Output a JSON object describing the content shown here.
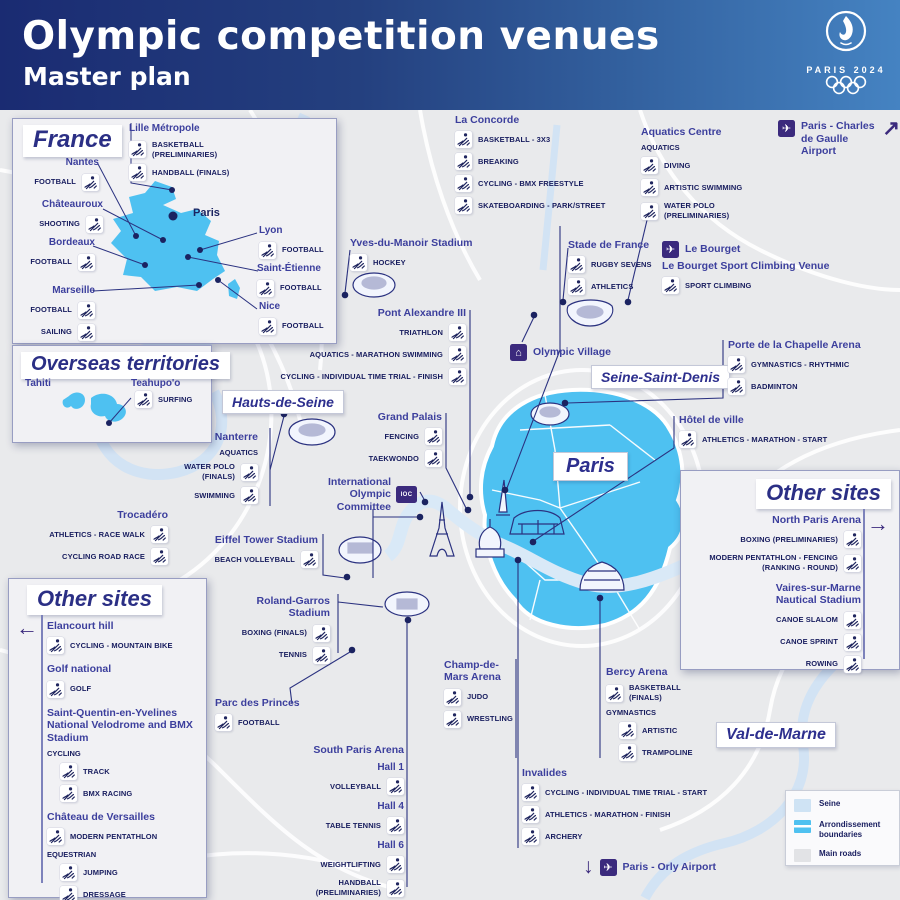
{
  "header": {
    "title": "Olympic competition venues",
    "subtitle": "Master plan",
    "brand": "PARIS 2024"
  },
  "colors": {
    "paris_area": "#4ec1f1",
    "seine": "#cfe3f4",
    "arrondissement": "#4fc1f0",
    "main_roads": "#e2e3e6",
    "navy_text": "#171c5e",
    "venue_name": "#3c3f9d",
    "purple": "#3b2a7d"
  },
  "map": {
    "regions": [
      {
        "id": "hauts-de-seine",
        "label": "Hauts-de-Seine"
      },
      {
        "id": "seine-saint-denis",
        "label": "Seine-Saint-Denis"
      },
      {
        "id": "paris",
        "label": "Paris"
      },
      {
        "id": "val-de-marne",
        "label": "Val-de-Marne"
      }
    ],
    "airports": {
      "cdg": {
        "label": "Paris - Charles de Gaulle Airport",
        "arrow": "↗"
      },
      "orly": {
        "label": "Paris - Orly Airport",
        "arrow": "↓"
      }
    },
    "callouts": [
      {
        "id": "la-concorde",
        "name": "La Concorde",
        "rows": [
          {
            "icon": "basketball-3x3-icon",
            "label": "BASKETBALL - 3X3"
          },
          {
            "icon": "breaking-icon",
            "label": "BREAKING"
          },
          {
            "icon": "bmx-freestyle-icon",
            "label": "CYCLING - BMX FREESTYLE"
          },
          {
            "icon": "skateboarding-icon",
            "label": "SKATEBOARDING - PARK/STREET"
          }
        ]
      },
      {
        "id": "aquatics-centre",
        "name": "Aquatics Centre",
        "rows": [
          {
            "sub": "AQUATICS",
            "style": "caps"
          },
          {
            "icon": "diving-icon",
            "label": "DIVING"
          },
          {
            "icon": "artistic-swimming-icon",
            "label": "ARTISTIC SWIMMING"
          },
          {
            "icon": "water-polo-icon",
            "label": "WATER POLO (PRELIMINARIES)"
          }
        ]
      },
      {
        "id": "yves-du-manoir",
        "name": "Yves-du-Manoir Stadium",
        "rows": [
          {
            "icon": "hockey-icon",
            "label": "HOCKEY"
          }
        ]
      },
      {
        "id": "stade-de-france",
        "name": "Stade de France",
        "rows": [
          {
            "icon": "rugby-sevens-icon",
            "label": "RUGBY SEVENS"
          },
          {
            "icon": "athletics-icon",
            "label": "ATHLETICS"
          }
        ]
      },
      {
        "id": "le-bourget",
        "name": "Le Bourget",
        "plane": true,
        "name2": "Le Bourget Sport Climbing Venue",
        "rows": [
          {
            "icon": "sport-climbing-icon",
            "label": "SPORT CLIMBING"
          }
        ]
      },
      {
        "id": "pont-alexandre-iii",
        "name": "Pont Alexandre III",
        "align": "R",
        "rows": [
          {
            "icon": "triathlon-icon",
            "label": "TRIATHLON"
          },
          {
            "icon": "marathon-swimming-icon",
            "label": "AQUATICS - MARATHON SWIMMING"
          },
          {
            "icon": "cycling-time-trial-icon",
            "label": "CYCLING - INDIVIDUAL TIME TRIAL - FINISH"
          }
        ]
      },
      {
        "id": "olympic-village",
        "name": "Olympic Village",
        "chip": "village",
        "rows": []
      },
      {
        "id": "porte-de-la-chapelle",
        "name": "Porte de la Chapelle Arena",
        "rows": [
          {
            "icon": "rhythmic-gymnastics-icon",
            "label": "GYMNASTICS - RHYTHMIC"
          },
          {
            "icon": "badminton-icon",
            "label": "BADMINTON"
          }
        ]
      },
      {
        "id": "grand-palais",
        "name": "Grand Palais",
        "align": "R",
        "rows": [
          {
            "icon": "fencing-icon",
            "label": "FENCING"
          },
          {
            "icon": "taekwondo-icon",
            "label": "TAEKWONDO"
          }
        ]
      },
      {
        "id": "hotel-de-ville",
        "name": "Hôtel de ville",
        "rows": [
          {
            "icon": "marathon-icon",
            "label": "ATHLETICS - MARATHON - START"
          }
        ]
      },
      {
        "id": "paris-la-defense",
        "name": "Paris la Défense Arena - Nanterre",
        "align": "R",
        "rows": [
          {
            "sub": "AQUATICS",
            "style": "caps"
          },
          {
            "icon": "water-polo-icon",
            "label": "WATER POLO (FINALS)"
          },
          {
            "icon": "swimming-icon",
            "label": "SWIMMING"
          }
        ]
      },
      {
        "id": "ioc",
        "name": "International Olympic Committee",
        "chip": "IOC",
        "align": "R",
        "rows": []
      },
      {
        "id": "trocadero",
        "name": "Trocadéro",
        "align": "R",
        "rows": [
          {
            "icon": "race-walk-icon",
            "label": "ATHLETICS - RACE WALK"
          },
          {
            "icon": "road-cycling-icon",
            "label": "CYCLING ROAD RACE"
          }
        ]
      },
      {
        "id": "eiffel-tower-stadium",
        "name": "Eiffel Tower Stadium",
        "align": "R",
        "rows": [
          {
            "icon": "beach-volleyball-icon",
            "label": "BEACH VOLLEYBALL"
          }
        ]
      },
      {
        "id": "roland-garros",
        "name": "Roland-Garros Stadium",
        "align": "R",
        "rows": [
          {
            "icon": "boxing-icon",
            "label": "BOXING (FINALS)"
          },
          {
            "icon": "tennis-icon",
            "label": "TENNIS"
          }
        ]
      },
      {
        "id": "parc-des-princes",
        "name": "Parc des Princes",
        "rows": [
          {
            "icon": "football-icon",
            "label": "FOOTBALL"
          }
        ]
      },
      {
        "id": "champ-de-mars",
        "name": "Champ-de-Mars Arena",
        "rows": [
          {
            "icon": "judo-icon",
            "label": "JUDO"
          },
          {
            "icon": "wrestling-icon",
            "label": "WRESTLING"
          }
        ]
      },
      {
        "id": "bercy",
        "name": "Bercy Arena",
        "rows": [
          {
            "icon": "basketball-icon",
            "label": "BASKETBALL (FINALS)"
          },
          {
            "sub": "GYMNASTICS",
            "style": "caps"
          },
          {
            "icon": "artistic-gymnastics-icon",
            "label": "ARTISTIC",
            "indent": true
          },
          {
            "icon": "trampoline-icon",
            "label": "TRAMPOLINE",
            "indent": true
          }
        ]
      },
      {
        "id": "south-paris-arena",
        "name": "South Paris Arena",
        "align": "R",
        "rows": [
          {
            "sub": "Hall 1",
            "style": "hall"
          },
          {
            "icon": "volleyball-icon",
            "label": "VOLLEYBALL"
          },
          {
            "sub": "Hall 4",
            "style": "hall"
          },
          {
            "icon": "table-tennis-icon",
            "label": "TABLE TENNIS"
          },
          {
            "sub": "Hall 6",
            "style": "hall"
          },
          {
            "icon": "weightlifting-icon",
            "label": "WEIGHTLIFTING"
          },
          {
            "icon": "handball-icon",
            "label": "HANDBALL (PRELIMINARIES)"
          }
        ]
      },
      {
        "id": "invalides",
        "name": "Invalides",
        "rows": [
          {
            "icon": "cycling-time-trial-icon",
            "label": "CYCLING - INDIVIDUAL TIME TRIAL - START"
          },
          {
            "icon": "marathon-icon",
            "label": "ATHLETICS - MARATHON - FINISH"
          },
          {
            "icon": "archery-icon",
            "label": "ARCHERY"
          }
        ]
      }
    ],
    "legend": {
      "items": [
        {
          "name": "seine",
          "label": "Seine",
          "color": "#cfe3f4"
        },
        {
          "name": "arrondissement-boundaries",
          "label": "Arrondissement boundaries",
          "color": "#4fc1f0"
        },
        {
          "name": "main-roads",
          "label": "Main roads",
          "color": "#e2e3e6"
        }
      ]
    }
  },
  "france_box": {
    "title": "France",
    "paris_label": "Paris",
    "cities": [
      {
        "id": "lille",
        "name": "Lille Métropole",
        "rows": [
          {
            "icon": "basketball-icon",
            "label": "BASKETBALL (PRELIMINARIES)"
          },
          {
            "icon": "handball-icon",
            "label": "HANDBALL (FINALS)"
          }
        ]
      },
      {
        "id": "nantes",
        "name": "Nantes",
        "align": "R",
        "rows": [
          {
            "icon": "football-icon",
            "label": "FOOTBALL"
          }
        ]
      },
      {
        "id": "chateauroux",
        "name": "Châteauroux",
        "align": "R",
        "rows": [
          {
            "icon": "shooting-icon",
            "label": "SHOOTING"
          }
        ]
      },
      {
        "id": "bordeaux",
        "name": "Bordeaux",
        "align": "R",
        "rows": [
          {
            "icon": "football-icon",
            "label": "FOOTBALL"
          }
        ]
      },
      {
        "id": "marseille",
        "name": "Marseille",
        "align": "R",
        "rows": [
          {
            "icon": "football-icon",
            "label": "FOOTBALL"
          },
          {
            "icon": "sailing-icon",
            "label": "SAILING"
          }
        ]
      },
      {
        "id": "lyon",
        "name": "Lyon",
        "rows": [
          {
            "icon": "football-icon",
            "label": "FOOTBALL"
          }
        ]
      },
      {
        "id": "saint-etienne",
        "name": "Saint-Étienne",
        "rows": [
          {
            "icon": "football-icon",
            "label": "FOOTBALL"
          }
        ]
      },
      {
        "id": "nice",
        "name": "Nice",
        "rows": [
          {
            "icon": "football-icon",
            "label": "FOOTBALL"
          }
        ]
      }
    ]
  },
  "overseas_box": {
    "title": "Overseas territories",
    "tahiti_label": "Tahiti",
    "teahupoo_label": "Teahupo'o",
    "rows": [
      {
        "icon": "surfing-icon",
        "label": "SURFING"
      }
    ]
  },
  "other_sites_left": {
    "title": "Other sites",
    "venues": [
      {
        "name": "Elancourt hill",
        "rows": [
          {
            "icon": "mountain-bike-icon",
            "label": "CYCLING - MOUNTAIN BIKE"
          }
        ]
      },
      {
        "name": "Golf national",
        "rows": [
          {
            "icon": "golf-icon",
            "label": "GOLF"
          }
        ]
      },
      {
        "name": "Saint-Quentin-en-Yvelines National Velodrome and BMX Stadium",
        "rows": [
          {
            "sub": "CYCLING",
            "style": "caps"
          },
          {
            "icon": "track-cycling-icon",
            "label": "TRACK",
            "indent": true
          },
          {
            "icon": "bmx-racing-icon",
            "label": "BMX RACING",
            "indent": true
          }
        ]
      },
      {
        "name": "Château de Versailles",
        "rows": [
          {
            "icon": "modern-pentathlon-icon",
            "label": "MODERN PENTATHLON"
          },
          {
            "sub": "EQUESTRIAN",
            "style": "caps"
          },
          {
            "icon": "equestrian-jumping-icon",
            "label": "JUMPING",
            "indent": true
          },
          {
            "icon": "dressage-icon",
            "label": "DRESSAGE",
            "indent": true
          },
          {
            "icon": "eventing-icon",
            "label": "EVENTING",
            "indent": true
          }
        ]
      }
    ]
  },
  "other_sites_right": {
    "title": "Other sites",
    "venues": [
      {
        "name": "North Paris Arena",
        "rows": [
          {
            "icon": "boxing-icon",
            "label": "BOXING (PRELIMINARIES)"
          },
          {
            "icon": "modern-pentathlon-fencing-icon",
            "label": "MODERN PENTATHLON - FENCING (RANKING - ROUND)"
          }
        ]
      },
      {
        "name": "Vaires-sur-Marne Nautical Stadium",
        "rows": [
          {
            "icon": "canoe-slalom-icon",
            "label": "CANOE SLALOM"
          },
          {
            "icon": "canoe-sprint-icon",
            "label": "CANOE SPRINT"
          },
          {
            "icon": "rowing-icon",
            "label": "ROWING"
          }
        ]
      }
    ]
  }
}
